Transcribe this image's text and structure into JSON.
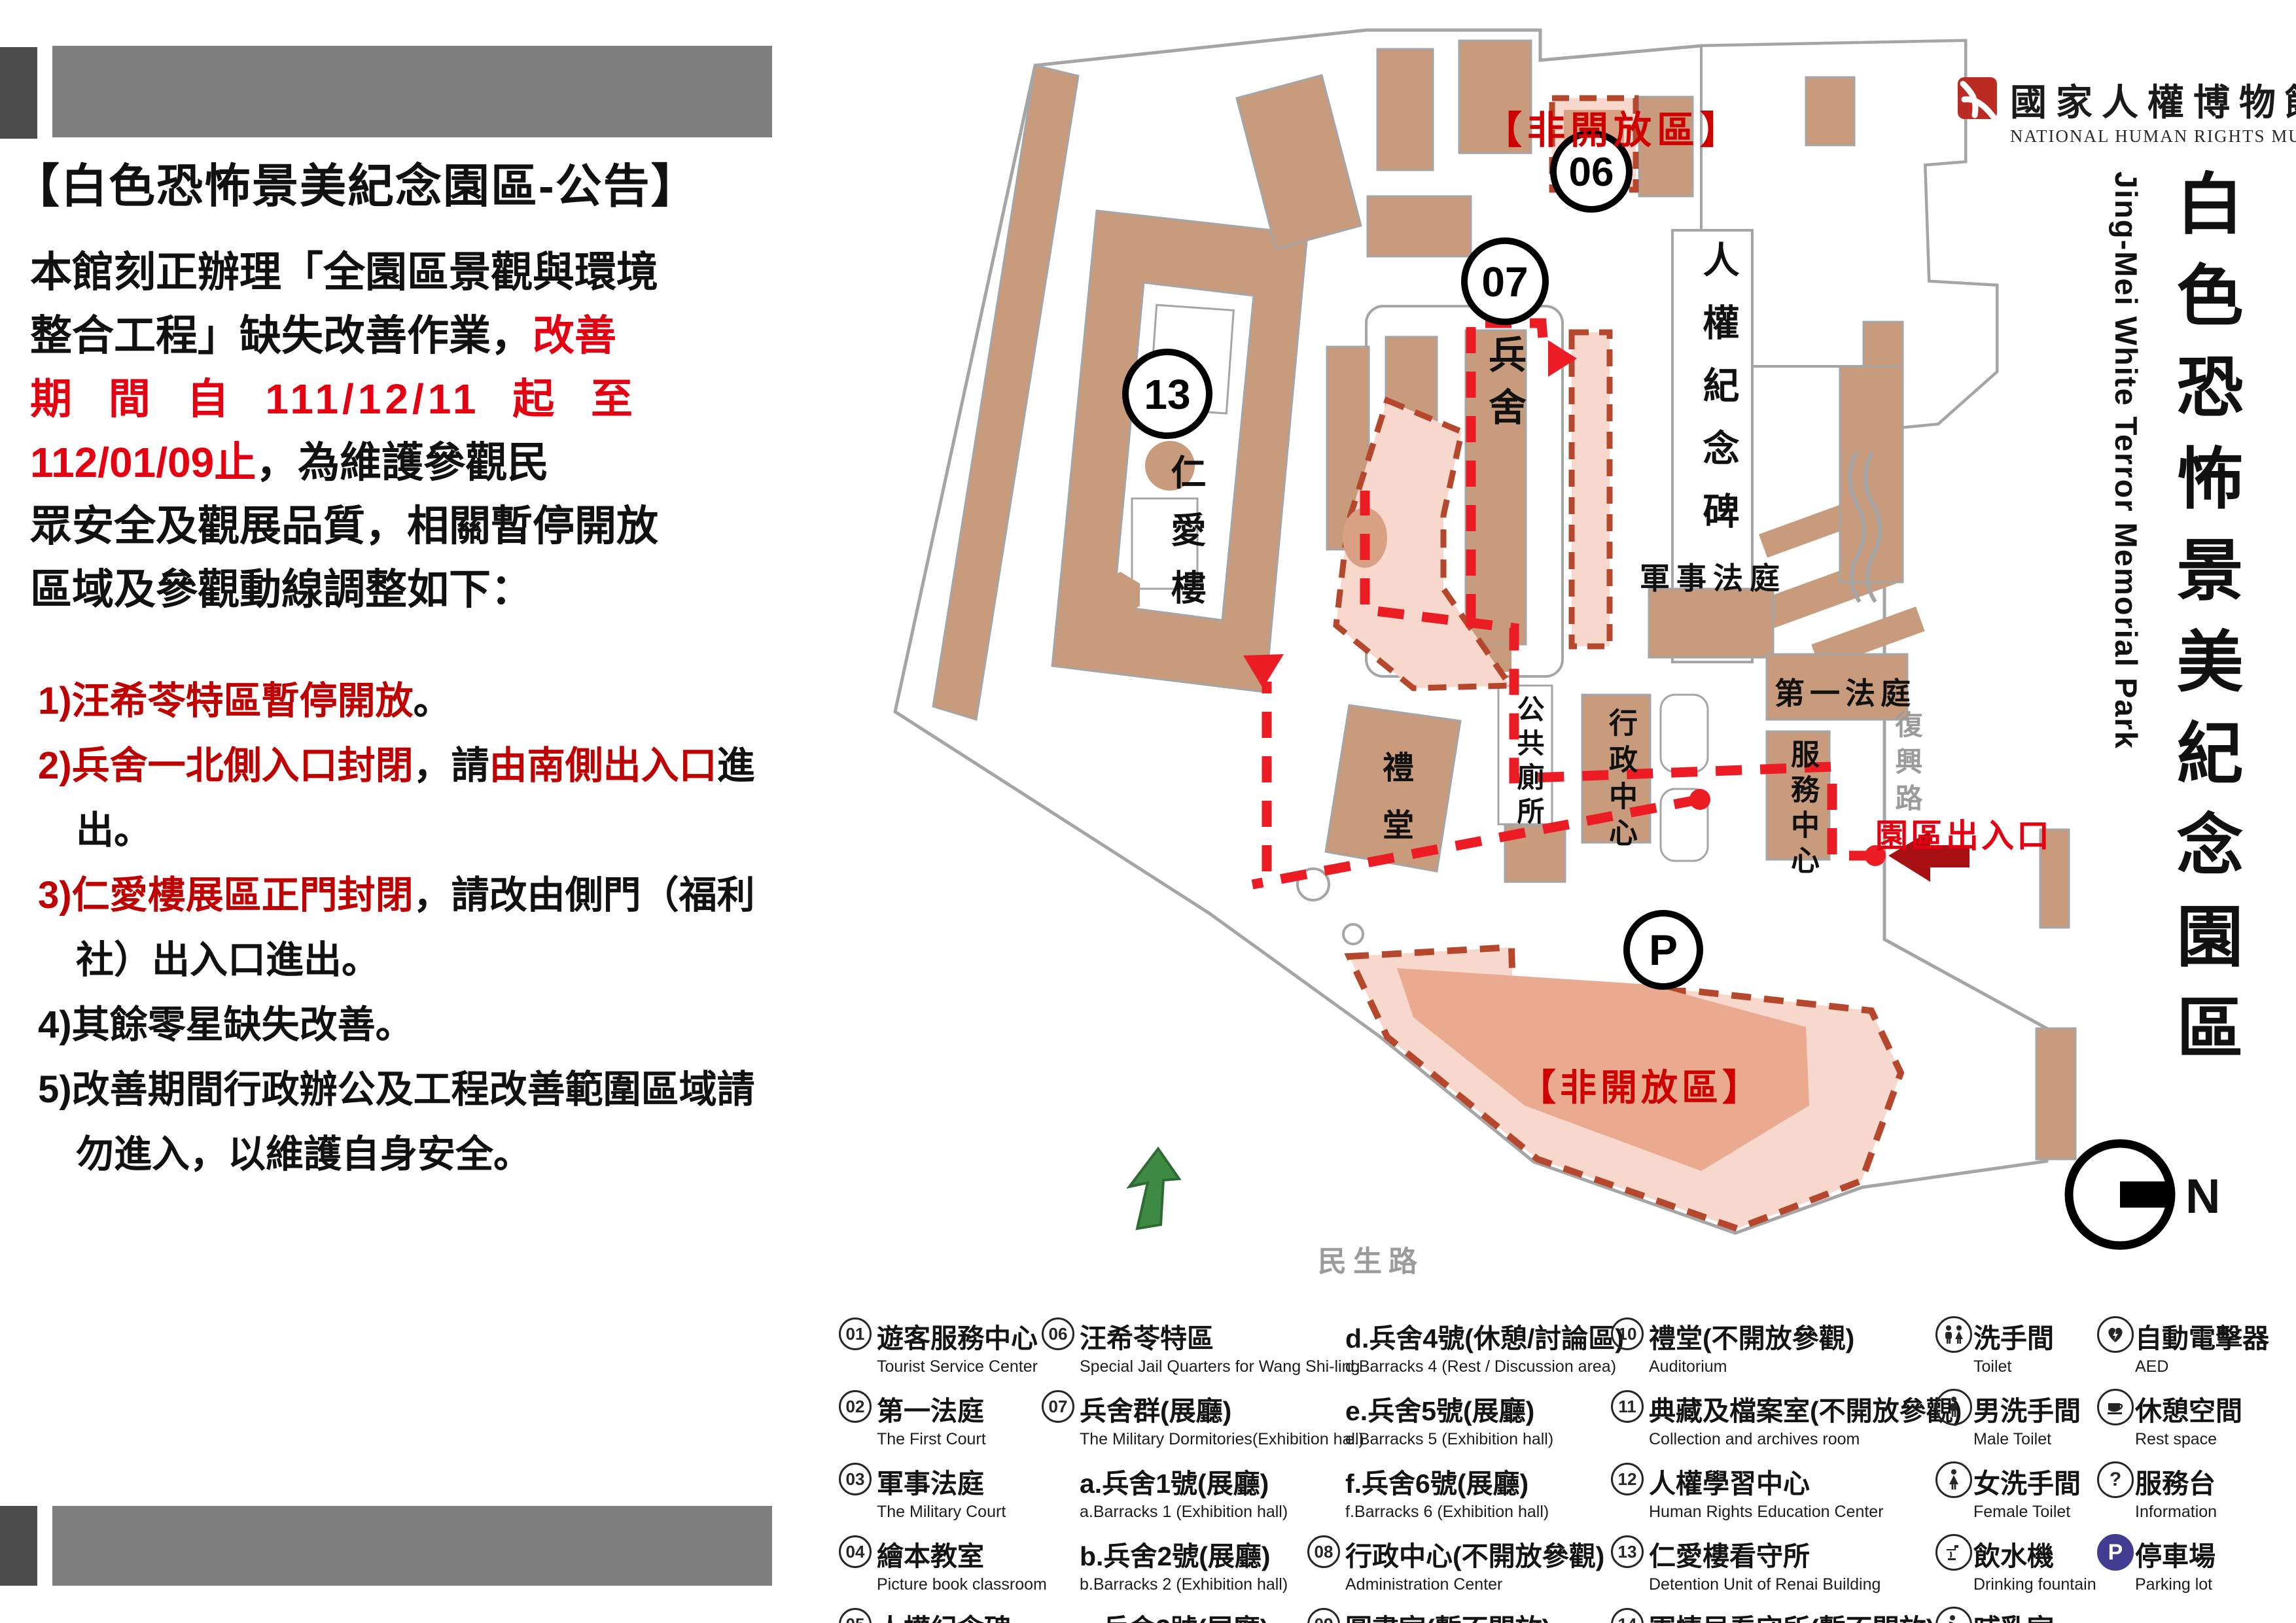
{
  "announcement": {
    "title": "【白色恐怖景美紀念園區-公告】",
    "p1": "本館刻正辦理「全園區景觀與環境",
    "p2_black": "整合工程」缺失改善作業，",
    "p2_red": "改善",
    "p3_red": "期 間 自 111/12/11 起 至",
    "p4_red": "112/01/09止",
    "p4_black": "，為維護參觀民",
    "p5": "眾安全及觀展品質，相關暫停開放",
    "p6": "區域及參觀動線調整如下：",
    "i1_red": "1)汪希苓特區暫停開放",
    "i1_black": "。",
    "i2_red1": "2)兵舍一北側入口封閉",
    "i2_black1": "，請",
    "i2_red2": "由南側出入口",
    "i2_black2": "進出。",
    "i3_red": "3)仁愛樓展區正門封閉",
    "i3_black": "，請改由側門（福利社）出入口進出。",
    "i4": "4)其餘零星缺失改善。",
    "i5": "5)改善期間行政辦公及工程改善範圍區域請勿進入，以維護自身安全。"
  },
  "map": {
    "zone_top": "【非開放區】",
    "zone_bottom": "【非開放區】",
    "entrance": "園區出入口",
    "marker_06": "06",
    "marker_07": "07",
    "marker_13": "13",
    "marker_p": "P",
    "bingshe": "兵舍",
    "renquan": "人權紀念碑",
    "junshi": "軍事法庭",
    "diyi": "第一法庭",
    "fuwu": "服務中心",
    "xingzheng": "行政中心",
    "cesuo": "公共廁所",
    "litang": "禮堂",
    "renai": "仁愛樓",
    "fuxing_rd": "復興路",
    "minsheng_rd": "民生路",
    "compass": "N"
  },
  "logo": {
    "zh": "國家人權博物館",
    "en": "NATIONAL HUMAN RIGHTS MUSEUM"
  },
  "side_title": {
    "zh": "白色恐怖景美紀念園區",
    "en": "Jing-Mei White Terror Memorial Park"
  },
  "icons": {
    "question": "?"
  },
  "legend": {
    "col1": [
      {
        "badge": "01",
        "zh": "遊客服務中心",
        "en": "Tourist Service Center"
      },
      {
        "badge": "02",
        "zh": "第一法庭",
        "en": "The First Court"
      },
      {
        "badge": "03",
        "zh": "軍事法庭",
        "en": "The Military Court"
      },
      {
        "badge": "04",
        "zh": "繪本教室",
        "en": "Picture book classroom"
      },
      {
        "badge": "05",
        "zh": "人權紀念碑",
        "en": "Human Rights Memorial"
      }
    ],
    "col2": [
      {
        "badge": "06",
        "zh": "汪希苓特區",
        "en": "Special Jail Quarters for Wang Shi-ling"
      },
      {
        "badge": "07",
        "zh": "兵舍群(展廳)",
        "en": "The Military Dormitories(Exhibition hall)"
      },
      {
        "zh": "a.兵舍1號(展廳)",
        "en": "a.Barracks 1 (Exhibition hall)"
      },
      {
        "zh": "b.兵舍2號(展廳)",
        "en": "b.Barracks 2 (Exhibition hall)"
      },
      {
        "zh": "c.兵舍3號(展廳)",
        "en": "c.Barracks 3 (Exhibition hall)"
      }
    ],
    "col3": [
      {
        "zh": "d.兵舍4號(休憩/討論區)",
        "en": "d.Barracks 4 (Rest / Discussion area)"
      },
      {
        "zh": "e.兵舍5號(展廳)",
        "en": "e.Barracks 5 (Exhibition hall)"
      },
      {
        "zh": "f.兵舍6號(展廳)",
        "en": "f.Barracks 6 (Exhibition hall)"
      },
      {
        "badge": "08",
        "zh": "行政中心(不開放參觀)",
        "en": "Administration Center"
      },
      {
        "badge": "09",
        "zh": "圖書室(暫不開放)",
        "en": "Library"
      }
    ],
    "col4": [
      {
        "badge": "10",
        "zh": "禮堂(不開放參觀)",
        "en": "Auditorium"
      },
      {
        "badge": "11",
        "zh": "典藏及檔案室(不開放參觀)",
        "en": "Collection and archives room"
      },
      {
        "badge": "12",
        "zh": "人權學習中心",
        "en": "Human Rights Education Center"
      },
      {
        "badge": "13",
        "zh": "仁愛樓看守所",
        "en": "Detention Unit of Renai Building"
      },
      {
        "badge": "14",
        "zh": "軍情局看守所(暫不開放)",
        "en": "Detention Unit of Military Intelligence Bureau"
      }
    ],
    "col5": [
      {
        "zh": "洗手間",
        "en": "Toilet"
      },
      {
        "zh": "男洗手間",
        "en": "Male Toilet"
      },
      {
        "zh": "女洗手間",
        "en": "Female Toilet"
      },
      {
        "zh": "飲水機",
        "en": "Drinking fountain"
      },
      {
        "zh": "哺乳室",
        "en": "Nursing room"
      }
    ],
    "col6": [
      {
        "zh": "自動電擊器",
        "en": "AED"
      },
      {
        "zh": "休憩空間",
        "en": "Rest space"
      },
      {
        "zh": "服務台",
        "en": "Information"
      },
      {
        "zh": "停車場",
        "en": "Parking lot"
      }
    ]
  }
}
